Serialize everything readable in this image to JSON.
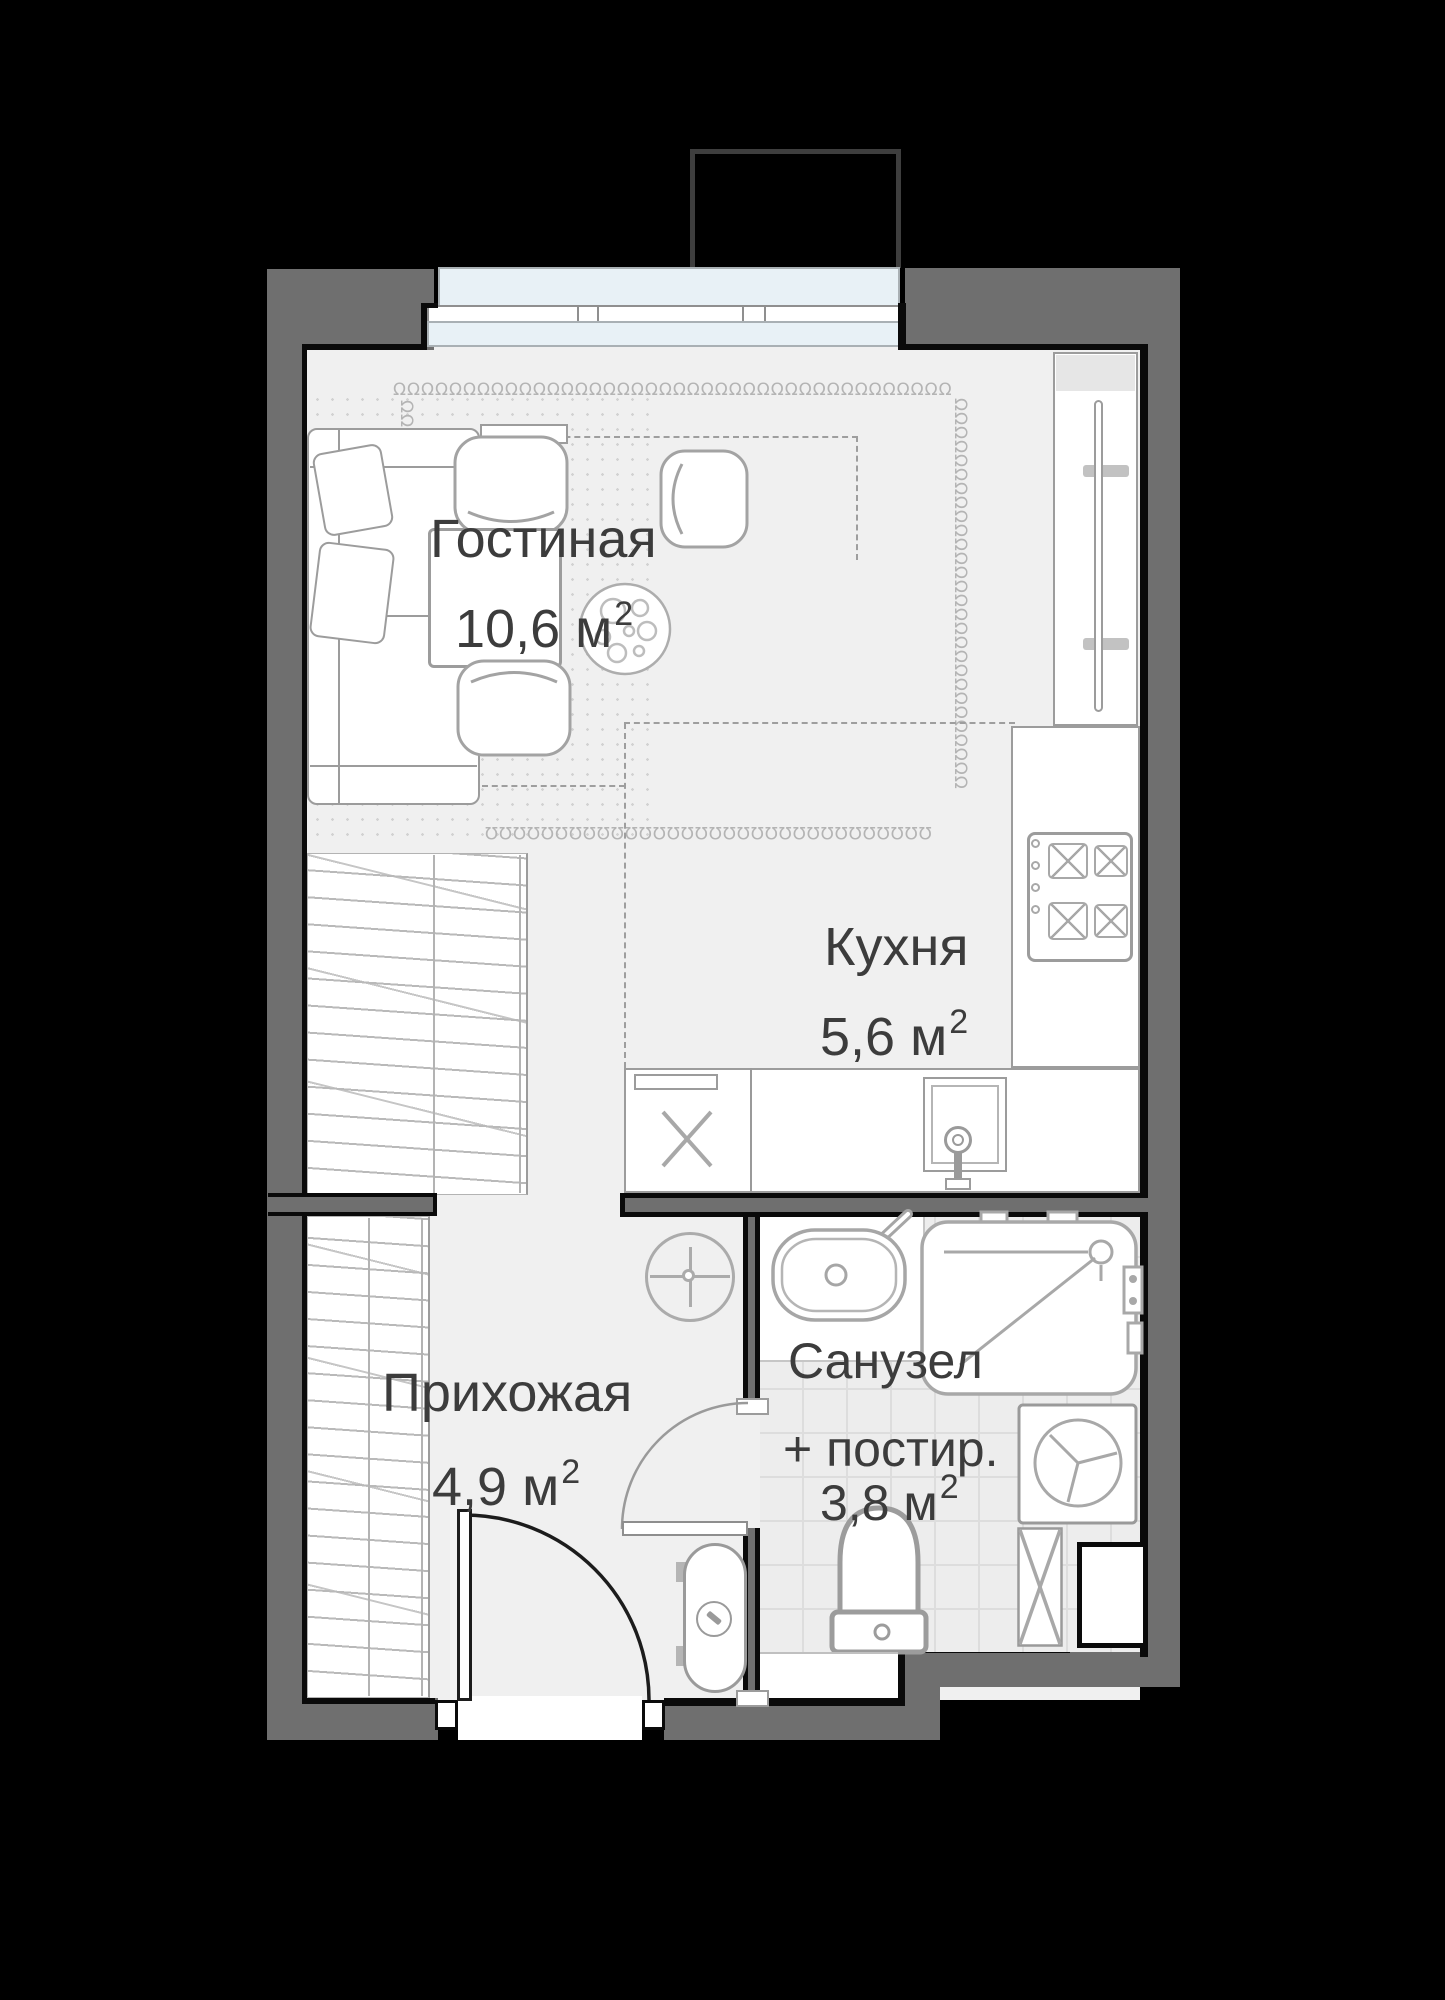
{
  "meta": {
    "type": "apartment-floor-plan",
    "style": "studio layout plan"
  },
  "rooms": {
    "living": {
      "name": "Гостиная",
      "area_label": "10,6 м",
      "area_sup": "2"
    },
    "kitchen": {
      "name": "Кухня",
      "area_label": "5,6 м",
      "area_sup": "2"
    },
    "hallway": {
      "name": "Прихожая",
      "area_label": "4,9 м",
      "area_sup": "2"
    },
    "bathroom": {
      "name": "Санузел",
      "name_line2": "+ постир.",
      "area_label": "3,8 м",
      "area_sup": "2"
    }
  },
  "decor": {
    "loops_top": "ΩΩΩΩΩΩΩΩΩΩΩΩΩΩΩΩΩΩΩΩΩΩΩΩΩΩΩΩΩΩΩΩΩΩΩΩΩΩΩΩ",
    "loops_right": "ΩΩΩΩΩΩΩΩΩΩΩΩΩΩΩΩΩΩΩΩΩΩΩΩΩΩΩΩ",
    "loops_bottom": "ΩΩΩΩΩΩΩΩΩΩΩΩΩΩΩΩΩΩΩΩΩΩΩΩΩΩΩΩΩΩΩΩ",
    "loops_left": "ΩΩΩΩ"
  },
  "colors": {
    "background": "#000000",
    "wall": "#6f6f6f",
    "inner_line": "#0a0a0a",
    "floor": "#f0f0f0",
    "glass": "#e8f1f6",
    "tile": "#ededed",
    "furniture_stroke": "#9c9c9c",
    "text": "#3c3c3c"
  }
}
